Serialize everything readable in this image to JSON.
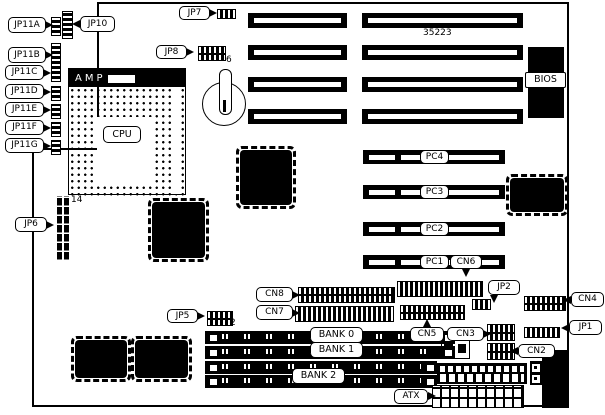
{
  "part_number": "35223",
  "labels": {
    "jp11a": "JP11A",
    "jp11b": "JP11B",
    "jp11c": "JP11C",
    "jp11d": "JP11D",
    "jp11e": "JP11E",
    "jp11f": "JP11F",
    "jp11g": "JP11G",
    "jp10": "JP10",
    "jp7": "JP7",
    "jp8": "JP8",
    "jp6": "JP6",
    "jp5": "JP5",
    "jp2": "JP2",
    "jp1": "JP1",
    "cn8": "CN8",
    "cn7": "CN7",
    "cn6": "CN6",
    "cn5": "CN5",
    "cn4": "CN4",
    "cn3": "CN3",
    "cn2": "CN2",
    "atx": "ATX",
    "bios": "BIOS",
    "cpu": "CPU",
    "amp": "AMP"
  },
  "pci_slots": [
    "PC4",
    "PC3",
    "PC2",
    "PC1"
  ],
  "memory_banks": [
    "BANK 0",
    "BANK 1",
    "BANK 2"
  ],
  "pin_counts": {
    "jp8": "6",
    "jp6": "14",
    "jp5": "2"
  },
  "colors": {
    "line": "#000000",
    "background": "#ffffff"
  }
}
